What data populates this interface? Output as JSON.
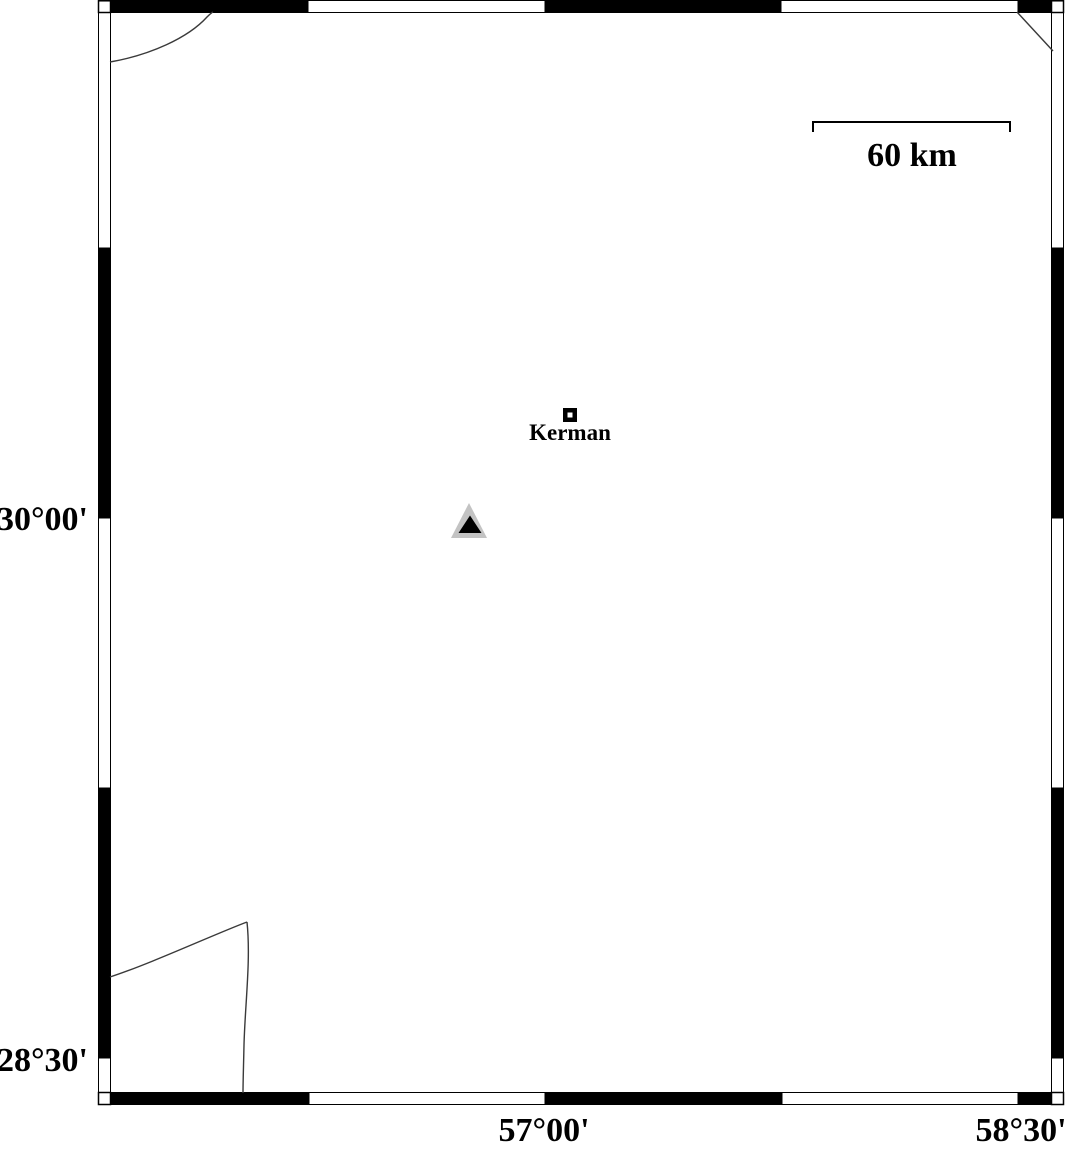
{
  "map": {
    "y_axis": {
      "labels": [
        "30°00'",
        "28°30'"
      ]
    },
    "x_axis": {
      "labels": [
        "57°00'",
        "58°30'"
      ]
    },
    "scale_bar": {
      "label": "60 km"
    },
    "city": {
      "name": "Kerman",
      "marker": "open-square"
    },
    "station": {
      "marker": "filled-triangle",
      "outer_color": "#c3c3c3",
      "inner_color": "#000000"
    },
    "colors": {
      "frame": "#000000",
      "background": "#ffffff",
      "contour_line": "#3a3a3a"
    }
  }
}
